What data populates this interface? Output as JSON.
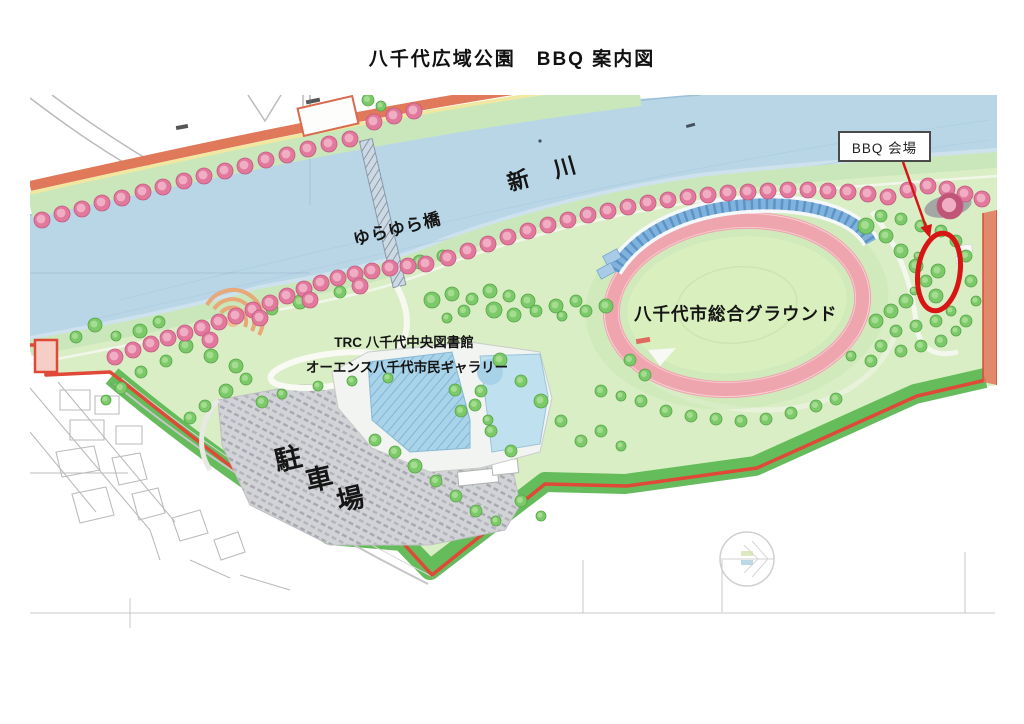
{
  "page": {
    "title": "八千代広域公園　BBQ 案内図"
  },
  "map": {
    "labels": {
      "river": "新川",
      "bridge": "ゆらゆら橋",
      "stadium": "八千代市総合グラウンド",
      "library_line1": "TRC 八千代中央図書館",
      "library_line2": "オーエンス八千代市民ギャラリー",
      "parking": "駐車場",
      "bbq_venue": "BBQ 会場"
    },
    "colors": {
      "river": "#b9d6e7",
      "river_shallow": "#cfe3ed",
      "bank_green": "#c9e7ba",
      "park_green": "#daeec6",
      "dark_green_band": "#5eb854",
      "tree_green": "#7cc96a",
      "tree_green_light": "#a5dd90",
      "tree_pink": "#e2799c",
      "tree_pink_light": "#f0aec4",
      "road_orange": "#e0785a",
      "boundary_red": "#e04838",
      "track_pink": "#efa5ae",
      "infield_green": "#d9efbe",
      "stands_blue": "#7fb2dc",
      "parking_gray": "#d2d3d6",
      "highlight_red": "#d81414",
      "label_border": "#4a4a4a"
    },
    "pink_trees": [
      [
        42,
        220
      ],
      [
        62,
        214
      ],
      [
        82,
        209
      ],
      [
        102,
        203
      ],
      [
        122,
        198
      ],
      [
        143,
        192
      ],
      [
        163,
        187
      ],
      [
        184,
        181
      ],
      [
        204,
        176
      ],
      [
        225,
        171
      ],
      [
        245,
        166
      ],
      [
        266,
        160
      ],
      [
        287,
        155
      ],
      [
        308,
        149
      ],
      [
        329,
        144
      ],
      [
        350,
        139
      ],
      [
        374,
        122
      ],
      [
        394,
        116
      ],
      [
        414,
        111
      ],
      [
        115,
        357
      ],
      [
        133,
        350
      ],
      [
        151,
        344
      ],
      [
        168,
        338
      ],
      [
        185,
        333
      ],
      [
        202,
        328
      ],
      [
        219,
        322
      ],
      [
        236,
        316
      ],
      [
        253,
        310
      ],
      [
        270,
        303
      ],
      [
        287,
        296
      ],
      [
        304,
        289
      ],
      [
        321,
        283
      ],
      [
        338,
        278
      ],
      [
        355,
        274
      ],
      [
        372,
        271
      ],
      [
        390,
        268
      ],
      [
        408,
        266
      ],
      [
        426,
        264
      ],
      [
        448,
        258
      ],
      [
        468,
        251
      ],
      [
        488,
        244
      ],
      [
        508,
        237
      ],
      [
        528,
        231
      ],
      [
        548,
        225
      ],
      [
        568,
        220
      ],
      [
        588,
        215
      ],
      [
        608,
        211
      ],
      [
        628,
        207
      ],
      [
        648,
        203
      ],
      [
        668,
        200
      ],
      [
        688,
        197
      ],
      [
        708,
        195
      ],
      [
        728,
        193
      ],
      [
        748,
        192
      ],
      [
        768,
        191
      ],
      [
        788,
        190
      ],
      [
        808,
        190
      ],
      [
        828,
        191
      ],
      [
        848,
        192
      ],
      [
        868,
        194
      ],
      [
        888,
        197
      ],
      [
        908,
        190
      ],
      [
        928,
        186
      ],
      [
        947,
        189
      ],
      [
        965,
        194
      ],
      [
        982,
        199
      ],
      [
        210,
        340
      ],
      [
        260,
        318
      ],
      [
        310,
        300
      ],
      [
        360,
        286
      ],
      [
        950,
        206,
        13
      ]
    ],
    "green_trees": [
      [
        420,
        262,
        7
      ],
      [
        443,
        256,
        6
      ],
      [
        300,
        302,
        7
      ],
      [
        272,
        309,
        6
      ],
      [
        340,
        292,
        6
      ],
      [
        368,
        100,
        6
      ],
      [
        381,
        106,
        5
      ],
      [
        95,
        325,
        7
      ],
      [
        76,
        337,
        6
      ],
      [
        140,
        331,
        7
      ],
      [
        159,
        322,
        6
      ],
      [
        116,
        336,
        5
      ],
      [
        186,
        346,
        7
      ],
      [
        211,
        356,
        7
      ],
      [
        236,
        366,
        7
      ],
      [
        166,
        361,
        6
      ],
      [
        141,
        372,
        6
      ],
      [
        121,
        388,
        6
      ],
      [
        106,
        400,
        5
      ],
      [
        190,
        418,
        6
      ],
      [
        205,
        406,
        6
      ],
      [
        226,
        391,
        7
      ],
      [
        246,
        379,
        6
      ],
      [
        432,
        300,
        8
      ],
      [
        452,
        294,
        7
      ],
      [
        472,
        299,
        6
      ],
      [
        490,
        291,
        7
      ],
      [
        509,
        296,
        6
      ],
      [
        528,
        301,
        7
      ],
      [
        494,
        310,
        8
      ],
      [
        514,
        315,
        7
      ],
      [
        536,
        311,
        6
      ],
      [
        556,
        306,
        7
      ],
      [
        576,
        301,
        6
      ],
      [
        562,
        316,
        5
      ],
      [
        586,
        311,
        6
      ],
      [
        606,
        306,
        7
      ],
      [
        464,
        311,
        6
      ],
      [
        447,
        318,
        5
      ],
      [
        500,
        360,
        7
      ],
      [
        521,
        381,
        6
      ],
      [
        541,
        401,
        7
      ],
      [
        561,
        421,
        6
      ],
      [
        581,
        441,
        6
      ],
      [
        601,
        431,
        6
      ],
      [
        621,
        446,
        5
      ],
      [
        481,
        391,
        6
      ],
      [
        461,
        411,
        6
      ],
      [
        491,
        431,
        6
      ],
      [
        511,
        451,
        6
      ],
      [
        645,
        375,
        6
      ],
      [
        630,
        360,
        6
      ],
      [
        415,
        466,
        7
      ],
      [
        436,
        481,
        6
      ],
      [
        456,
        496,
        6
      ],
      [
        476,
        511,
        6
      ],
      [
        496,
        521,
        5
      ],
      [
        521,
        501,
        6
      ],
      [
        541,
        516,
        5
      ],
      [
        395,
        452,
        6
      ],
      [
        375,
        440,
        6
      ],
      [
        641,
        401,
        6
      ],
      [
        666,
        411,
        6
      ],
      [
        691,
        416,
        6
      ],
      [
        716,
        419,
        6
      ],
      [
        741,
        421,
        6
      ],
      [
        766,
        419,
        6
      ],
      [
        791,
        413,
        6
      ],
      [
        816,
        406,
        6
      ],
      [
        836,
        399,
        6
      ],
      [
        621,
        396,
        5
      ],
      [
        601,
        391,
        6
      ],
      [
        866,
        226,
        8
      ],
      [
        886,
        236,
        7
      ],
      [
        901,
        251,
        7
      ],
      [
        916,
        266,
        7
      ],
      [
        926,
        281,
        6
      ],
      [
        936,
        296,
        7
      ],
      [
        906,
        301,
        7
      ],
      [
        891,
        311,
        7
      ],
      [
        876,
        321,
        7
      ],
      [
        896,
        331,
        6
      ],
      [
        916,
        326,
        6
      ],
      [
        936,
        321,
        6
      ],
      [
        951,
        311,
        5
      ],
      [
        881,
        346,
        6
      ],
      [
        901,
        351,
        6
      ],
      [
        921,
        346,
        6
      ],
      [
        871,
        361,
        6
      ],
      [
        851,
        356,
        5
      ],
      [
        941,
        341,
        6
      ],
      [
        956,
        331,
        5
      ],
      [
        966,
        321,
        6
      ],
      [
        976,
        301,
        5
      ],
      [
        971,
        281,
        6
      ],
      [
        966,
        256,
        6
      ],
      [
        956,
        241,
        6
      ],
      [
        941,
        231,
        6
      ],
      [
        921,
        226,
        6
      ],
      [
        901,
        219,
        6
      ],
      [
        881,
        216,
        6
      ],
      [
        938,
        271,
        7
      ],
      [
        918,
        256,
        4
      ],
      [
        914,
        291,
        4
      ],
      [
        262,
        402,
        6
      ],
      [
        282,
        394,
        5
      ],
      [
        318,
        386,
        5
      ],
      [
        352,
        381,
        5
      ],
      [
        388,
        378,
        5
      ],
      [
        455,
        390,
        6
      ],
      [
        475,
        405,
        6
      ],
      [
        488,
        420,
        5
      ]
    ]
  }
}
